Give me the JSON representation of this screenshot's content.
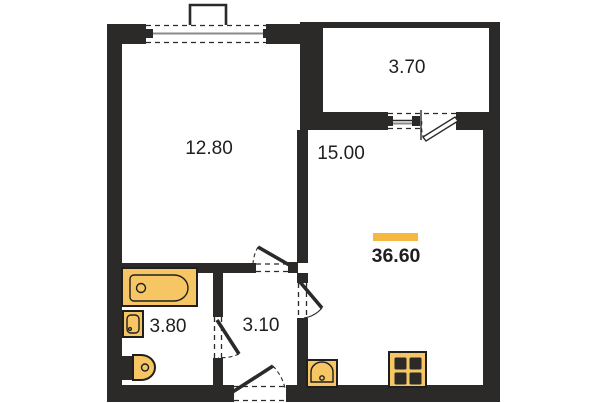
{
  "plan": {
    "rooms": [
      {
        "id": "bedroom",
        "area": "12.80"
      },
      {
        "id": "balcony",
        "area": "3.70"
      },
      {
        "id": "kitchen-living",
        "area": "15.00"
      },
      {
        "id": "bathroom",
        "area": "3.80"
      },
      {
        "id": "hallway",
        "area": "3.10"
      }
    ],
    "total_area": "36.60",
    "fixtures": [
      "bathtub",
      "washbasin",
      "toilet",
      "kitchen-sink",
      "stove"
    ],
    "colors": {
      "wall": "#2B2A29",
      "fixture_fill": "#F6C564",
      "fixture_stroke": "#1F1F1F",
      "highlight_bar": "#F5B942",
      "text": "#1F1F1F",
      "window_line": "#8A8A8A",
      "background": "#FFFFFF"
    }
  }
}
